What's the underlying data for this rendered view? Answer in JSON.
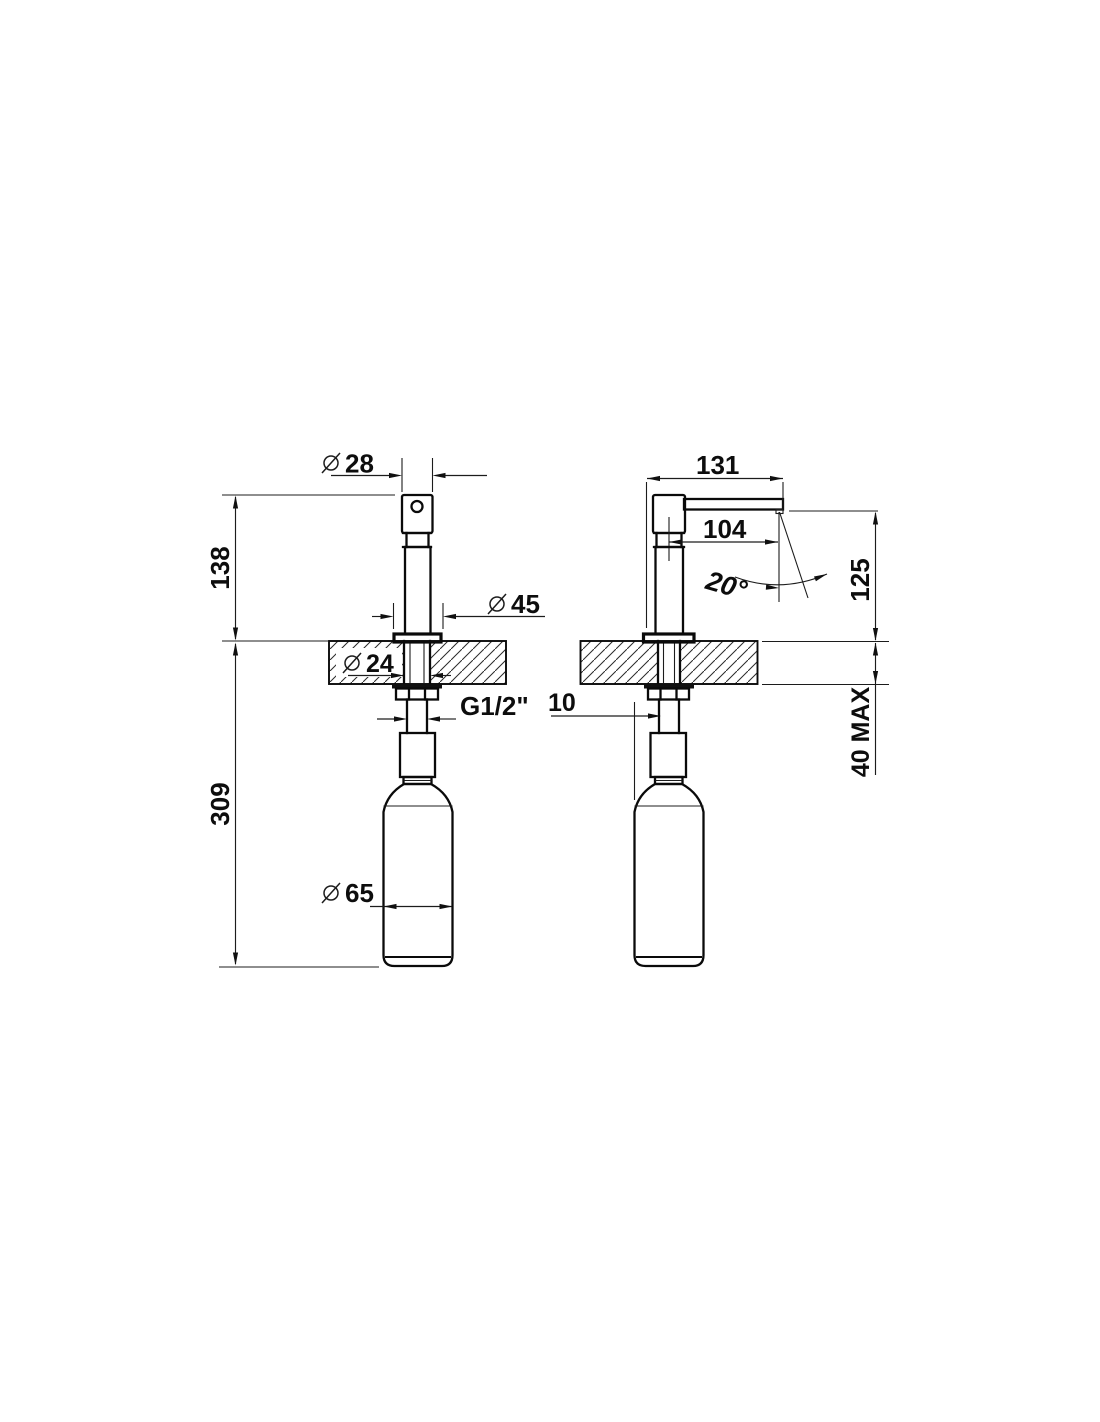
{
  "front_view": {
    "head_diameter_symbol": "Ø",
    "head_diameter": "28",
    "height_above_counter": "138",
    "flange_diameter_symbol": "Ø",
    "flange_diameter": "45",
    "hole_diameter_symbol": "Ø",
    "hole_diameter": "24",
    "thread_size": "G1/2\"",
    "length_below_counter": "309",
    "bottle_diameter_symbol": "Ø",
    "bottle_diameter": "65"
  },
  "side_view": {
    "overall_spout_reach": "131",
    "spout_reach_from_axis": "104",
    "swivel_angle": "20°",
    "spout_height_above_counter": "125",
    "counter_thickness_max": "40 MAX",
    "hole_edge_offset": "10"
  }
}
